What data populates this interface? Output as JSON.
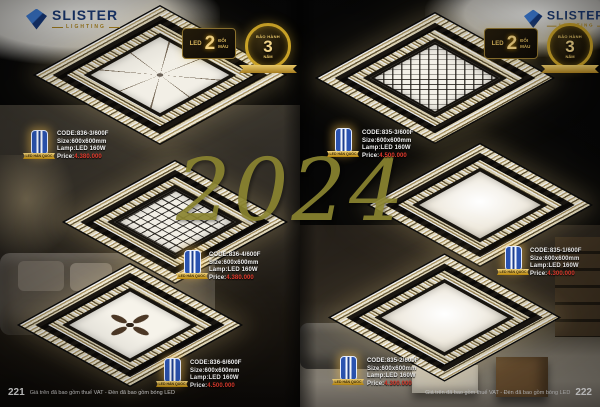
{
  "brand": {
    "name": "SLISTER",
    "tagline": "LIGHTING"
  },
  "badges": {
    "led": {
      "label": "LED",
      "count": "2",
      "sub_top": "ĐỔI",
      "sub_bottom": "MÀU"
    },
    "warranty": {
      "top": "BẢO HÀNH",
      "number": "3",
      "bottom": "NĂM"
    }
  },
  "quality_badge": {
    "ribbon": "LED HÀN QUỐC"
  },
  "watermark": "2024",
  "products": [
    {
      "code": "CODE:836-3/600F",
      "size": "Size:600x600mm",
      "lamp": "Lamp:LED 160W",
      "price_label": "Price:",
      "price": "4.380.000"
    },
    {
      "code": "CODE:836-4/600F",
      "size": "Size:600x600mm",
      "lamp": "Lamp:LED 160W",
      "price_label": "Price:",
      "price": "4.380.000"
    },
    {
      "code": "CODE:836-6/600F",
      "size": "Size:600x600mm",
      "lamp": "Lamp:LED 160W",
      "price_label": "Price:",
      "price": "4.500.000"
    },
    {
      "code": "CODE:835-3/600F",
      "size": "Size:600x600mm",
      "lamp": "Lamp:LED 160W",
      "price_label": "Price:",
      "price": "4.500.000"
    },
    {
      "code": "CODE:835-1/600F",
      "size": "Size:600x600mm",
      "lamp": "Lamp:LED 160W",
      "price_label": "Price:",
      "price": "4.300.000"
    },
    {
      "code": "CODE:835-2/600F",
      "size": "Size:600x600mm",
      "lamp": "Lamp:LED 160W",
      "price_label": "Price:",
      "price": "4.300.000"
    }
  ],
  "footer": {
    "left_page": "221",
    "right_page": "222",
    "caption": "Giá trên đã bao gồm thuế VAT - Đèn đã bao gồm bóng LED"
  },
  "colors": {
    "accent_gold": "#c9a227",
    "brand_navy": "#1b3a75",
    "price_red": "#e23b2e",
    "background": "#060606"
  }
}
